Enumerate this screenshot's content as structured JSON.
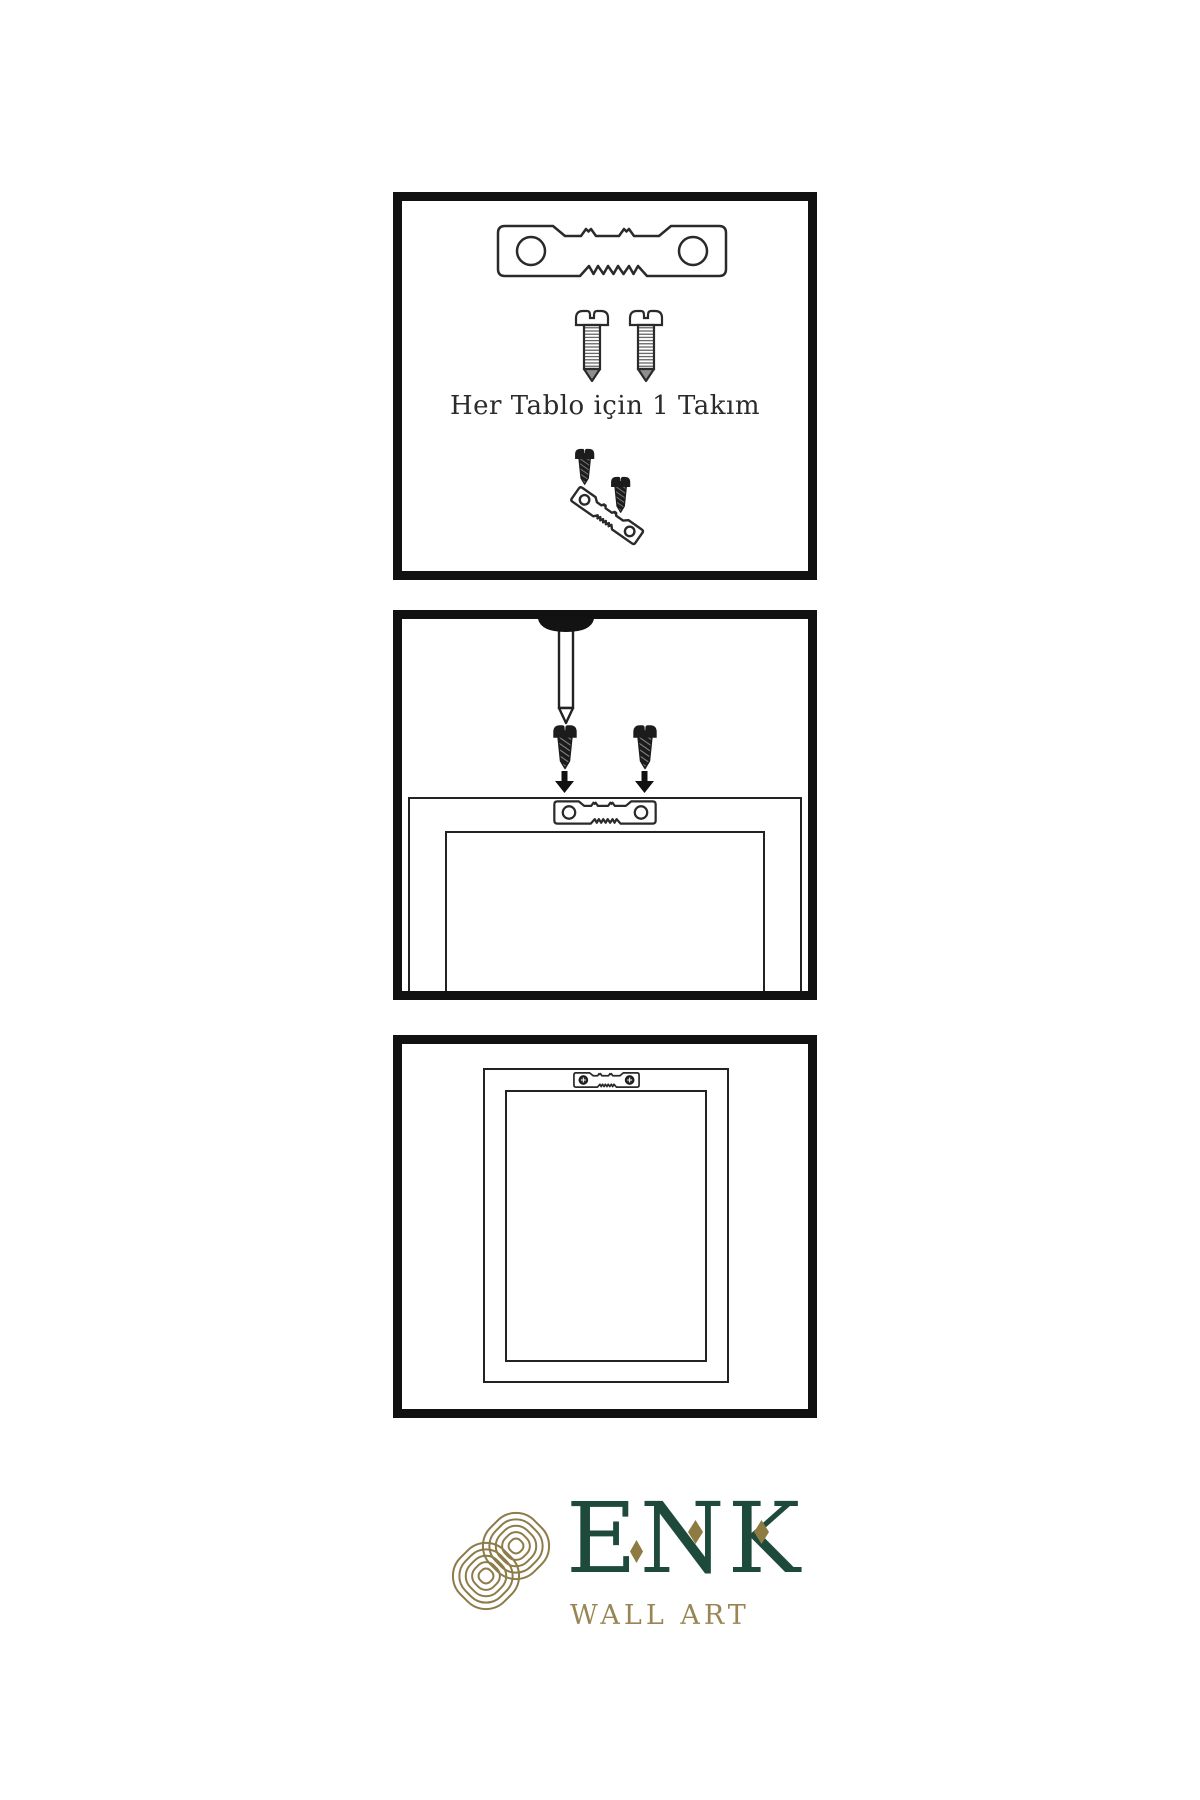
{
  "sheet": {
    "background": "#ffffff",
    "panel_border_color": "#111111",
    "diagram_line_color": "#2a2a2a",
    "caption_color": "#2b2b2b"
  },
  "panel_kit": {
    "caption": "Her Tablo için 1 Takım",
    "icons": [
      "sawtooth-hanger-icon",
      "screw-icon",
      "screw-icon",
      "hanger-assembly-icon"
    ]
  },
  "panel_install": {
    "icons": [
      "wall-nail-icon",
      "screw-icon",
      "screw-icon",
      "down-arrow-icon",
      "down-arrow-icon",
      "frame-with-hanger-icon"
    ]
  },
  "panel_hung": {
    "icons": [
      "framed-picture-icon",
      "mounted-hanger-icon"
    ]
  },
  "brand": {
    "name": "ENK",
    "subtitle": "WALL ART",
    "name_color": "#1e4a3c",
    "subtitle_color": "#9a8655",
    "knot_color": "#8d7b49"
  }
}
